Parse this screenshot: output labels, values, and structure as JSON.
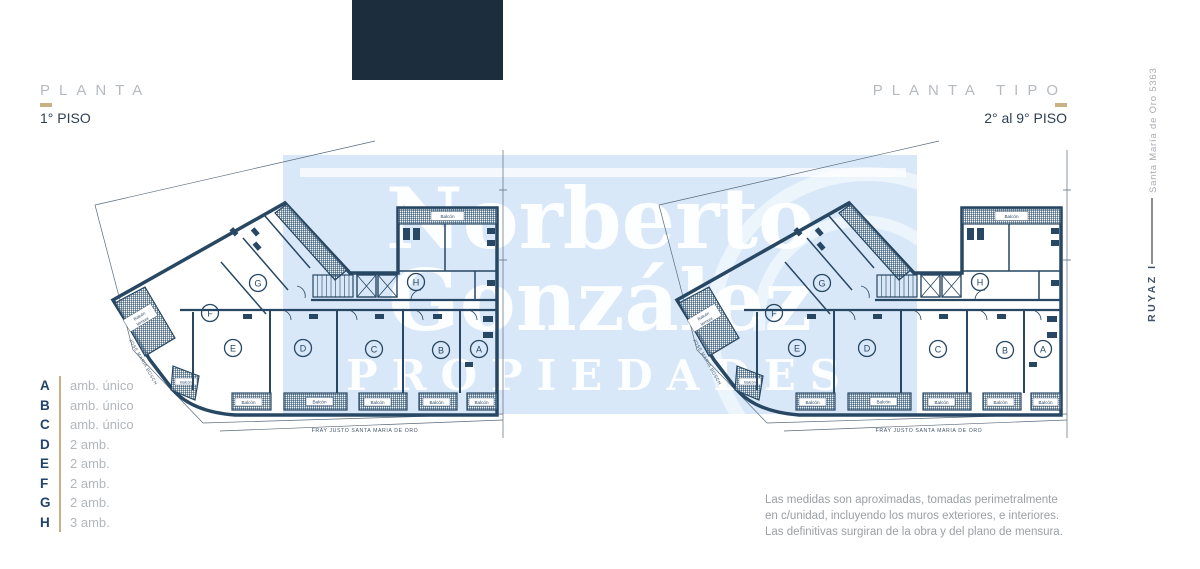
{
  "header_left": {
    "title": "PLANTA",
    "subtitle": "1° PISO"
  },
  "header_right": {
    "title": "PLANTA TIPO",
    "subtitle": "2° al 9° PISO"
  },
  "side": {
    "address": "Santa María de Oro 5363",
    "project": "RUYAZ I"
  },
  "watermark": {
    "line1": "Norberto",
    "line2": "González",
    "line3": "PROPIEDADES"
  },
  "plan": {
    "units": [
      {
        "letter": "A"
      },
      {
        "letter": "B"
      },
      {
        "letter": "C"
      },
      {
        "letter": "D"
      },
      {
        "letter": "E"
      },
      {
        "letter": "F"
      },
      {
        "letter": "G"
      },
      {
        "letter": "H"
      }
    ],
    "balcony_label": "Balcón",
    "balcony_terrace_line1": "Balcón",
    "balcony_terrace_line2": "terraza",
    "street_bottom": "FRAY JUSTO SANTA MARIA DE ORO",
    "street_side": "JOSE MARIA BOSCH"
  },
  "legend": {
    "items": [
      {
        "letter": "A",
        "desc": "amb. único"
      },
      {
        "letter": "B",
        "desc": "amb. único"
      },
      {
        "letter": "C",
        "desc": "amb. único"
      },
      {
        "letter": "D",
        "desc": "2 amb."
      },
      {
        "letter": "E",
        "desc": "2 amb."
      },
      {
        "letter": "F",
        "desc": "2 amb."
      },
      {
        "letter": "G",
        "desc": "2 amb."
      },
      {
        "letter": "H",
        "desc": "3 amb."
      }
    ]
  },
  "disclaimer": {
    "line1": "Las medidas son aproximadas, tomadas perimetralmente",
    "line2": "en c/unidad, incluyendo los muros exteriores,  e interiores.",
    "line3": "Las definitivas surgiran de la obra y del plano de mensura."
  },
  "colors": {
    "navy_block": "#1c2e3d",
    "wall_navy": "#274763",
    "gold": "#c9b183",
    "band_blue": "#d9e8f8",
    "gray_text": "#9aa0a6"
  }
}
